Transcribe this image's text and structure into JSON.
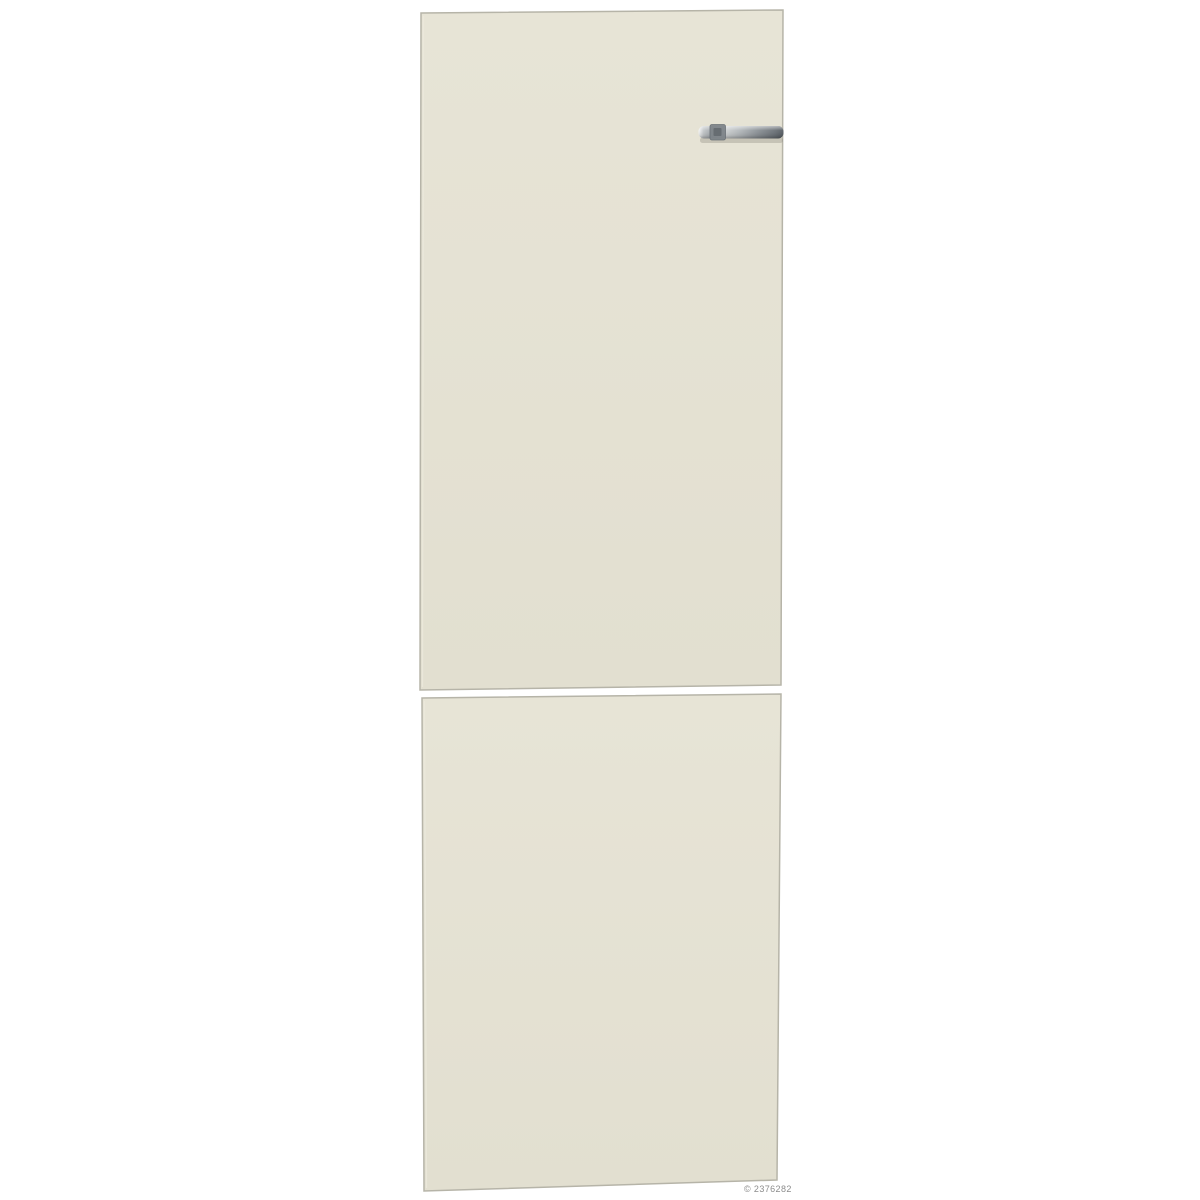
{
  "canvas": {
    "background": "#ffffff",
    "width": 1200,
    "height": 1200
  },
  "panels": {
    "fill_top": "#e7e4d6",
    "fill_bottom": "#e2dfd0",
    "border": "#b6b4a8",
    "inner_highlight": "#eceadd"
  },
  "handle": {
    "stops": [
      "#f5f6f6",
      "#c2c6c8",
      "#9aa0a4",
      "#cdd0d1",
      "#b0b5b8",
      "#8b9196",
      "#6b7177",
      "#575d63"
    ],
    "mount_fill": "#7f858a",
    "mount_stroke": "#676d73",
    "mount_detail": "#60666c",
    "shadow": "#8a887e"
  },
  "watermark": {
    "text": "© 2376282",
    "color": "#8c8c8c"
  }
}
